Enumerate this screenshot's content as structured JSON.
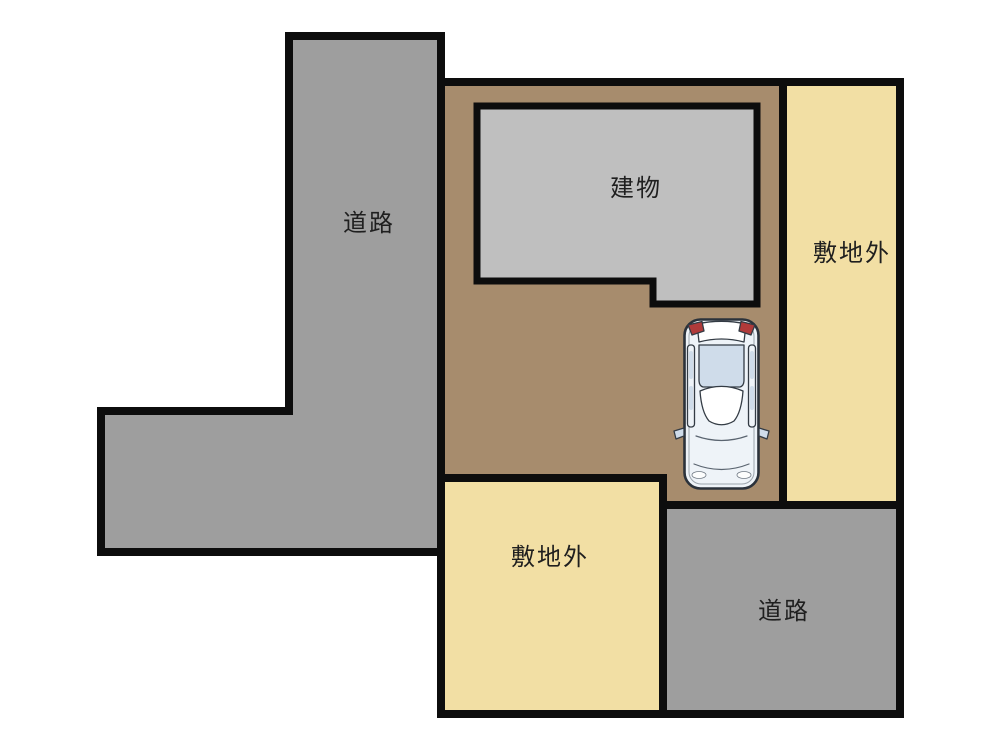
{
  "diagram": {
    "kind": "parking-site-plan",
    "regions": {
      "road_left": {
        "label": "道路"
      },
      "road_bottom": {
        "label": "道路"
      },
      "building": {
        "label": "建物"
      },
      "outside_right": {
        "label": "敷地外"
      },
      "outside_bottom": {
        "label": "敷地外"
      }
    },
    "colors": {
      "background": "#ffffff",
      "road": "#9e9e9e",
      "building": "#bfbfbf",
      "site": "#a78c6d",
      "outside": "#f2dfa4",
      "outline": "#0d0d0d",
      "label_text": "#1f1f1f",
      "car_body": "#eef3f8",
      "car_glass": "#cfdcea",
      "car_white": "#ffffff",
      "car_taillight": "#b03a3a"
    },
    "car": {
      "name": "car-top-view",
      "orientation": "front-facing-down"
    }
  }
}
